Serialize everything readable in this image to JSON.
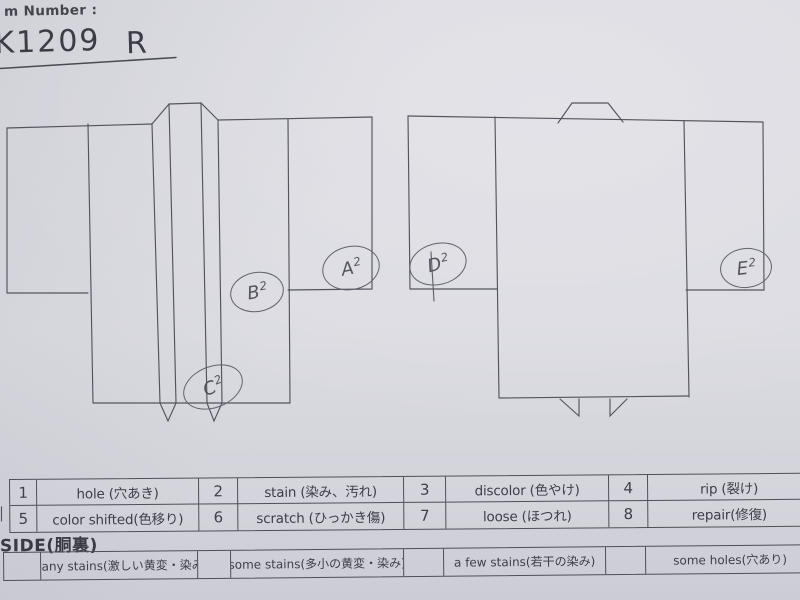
{
  "page": {
    "background_color": "#dfdfe5",
    "line_color": "#54545e",
    "text_color": "#3e3e48",
    "handwriting_color": "#55555f"
  },
  "header": {
    "label": "m Number :",
    "number": "K1209",
    "revision": "R"
  },
  "annotations": [
    {
      "id": "a2",
      "letter": "A",
      "digit": "2"
    },
    {
      "id": "b2",
      "letter": "B",
      "digit": "2"
    },
    {
      "id": "c2",
      "letter": "C",
      "digit": "2"
    },
    {
      "id": "d2",
      "letter": "D",
      "digit": "2"
    },
    {
      "id": "e2",
      "letter": "E",
      "digit": "2"
    }
  ],
  "legend_table": {
    "rows": [
      {
        "cells": [
          {
            "num": "1",
            "label": "hole (穴あき)"
          },
          {
            "num": "2",
            "label": "stain (染み、汚れ)"
          },
          {
            "num": "3",
            "label": "discolor (色やけ)"
          },
          {
            "num": "4",
            "label": "rip (裂け)"
          }
        ]
      },
      {
        "cells": [
          {
            "num": "5",
            "label": "color shifted(色移り)"
          },
          {
            "num": "6",
            "label": "scratch (ひっかき傷)"
          },
          {
            "num": "7",
            "label": "loose (ほつれ)"
          },
          {
            "num": "8",
            "label": "repair(修復)"
          }
        ]
      }
    ]
  },
  "inside_section": {
    "title": "SIDE(胴裏)",
    "options": [
      "many stains(激しい黄変・染み)",
      "some stains(多小の黄変・染み)",
      "a few stains(若干の染み)",
      "some holes(穴あり)"
    ]
  }
}
